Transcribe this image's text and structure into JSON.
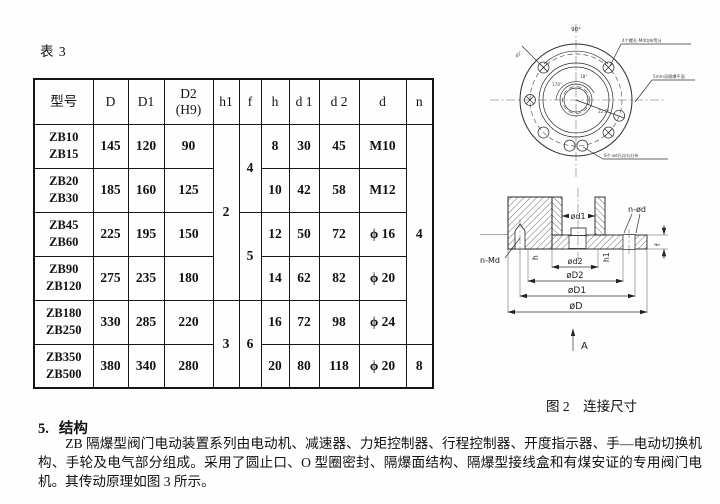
{
  "table": {
    "label": "表 3",
    "headers": {
      "model": "型号",
      "D": "D",
      "D1": "D1",
      "D2": "D2",
      "D2_fit": "(H9)",
      "h1": "h1",
      "f": "f",
      "h": "h",
      "d1": "d 1",
      "d2": "d 2",
      "d": "d",
      "n": "n"
    },
    "rows": [
      {
        "model1": "ZB10",
        "model2": "ZB15",
        "D": "145",
        "D1": "120",
        "D2": "90",
        "h": "8",
        "d1": "30",
        "d2": "45",
        "d": "M10"
      },
      {
        "model1": "ZB20",
        "model2": "ZB30",
        "D": "185",
        "D1": "160",
        "D2": "125",
        "h": "10",
        "d1": "42",
        "d2": "58",
        "d": "M12"
      },
      {
        "model1": "ZB45",
        "model2": "ZB60",
        "D": "225",
        "D1": "195",
        "D2": "150",
        "h": "12",
        "d1": "50",
        "d2": "72",
        "d": "ϕ 16"
      },
      {
        "model1": "ZB90",
        "model2": "ZB120",
        "D": "275",
        "D1": "235",
        "D2": "180",
        "h": "14",
        "d1": "62",
        "d2": "82",
        "d": "ϕ 20"
      },
      {
        "model1": "ZB180",
        "model2": "ZB250",
        "D": "330",
        "D1": "285",
        "D2": "220",
        "h": "16",
        "d1": "72",
        "d2": "98",
        "d": "ϕ 24"
      },
      {
        "model1": "ZB350",
        "model2": "ZB500",
        "D": "380",
        "D1": "340",
        "D2": "280",
        "h": "20",
        "d1": "80",
        "d2": "118",
        "d": "ϕ 20"
      }
    ],
    "h1_spans": {
      "top": "2",
      "bottom": "3"
    },
    "f_spans": {
      "top": "4",
      "mid": "5",
      "bottom": "6"
    },
    "n_spans": {
      "top": "4",
      "bottom": "8"
    }
  },
  "figure": {
    "caption": "图 2　连接尺寸",
    "top_view": {
      "angle_top": "90°",
      "angle_arc": "170°",
      "angle_inner": "18°",
      "angle_right": "22.5°",
      "angle_left": "45°",
      "callout_top": "4个螺孔-Md均布等分",
      "callout_right": "5mm深隔爆平面",
      "callout_bottom": "8个-ød孔均匀分布"
    },
    "section_view": {
      "dim_nd": "n-ød",
      "dim_d1_bore": "ød1",
      "dim_nmd": "n-Md",
      "dim_h": "h",
      "dim_d2_small": "ød2",
      "dim_h1": "h1",
      "dim_f": "f",
      "dim_D2": "øD2",
      "dim_D1": "øD1",
      "dim_D": "øD",
      "view_arrow": "A"
    }
  },
  "section": {
    "number": "5.",
    "title": "结构",
    "body": "ZB 隔爆型阀门电动装置系列由电动机、减速器、力矩控制器、行程控制器、开度指示器、手—电动切换机构、手轮及电气部分组成。采用了圆止口、O 型圈密封、隔爆面结构、隔爆型接线盒和有煤安证的专用阀门电机。其传动原理如图 3 所示。"
  }
}
